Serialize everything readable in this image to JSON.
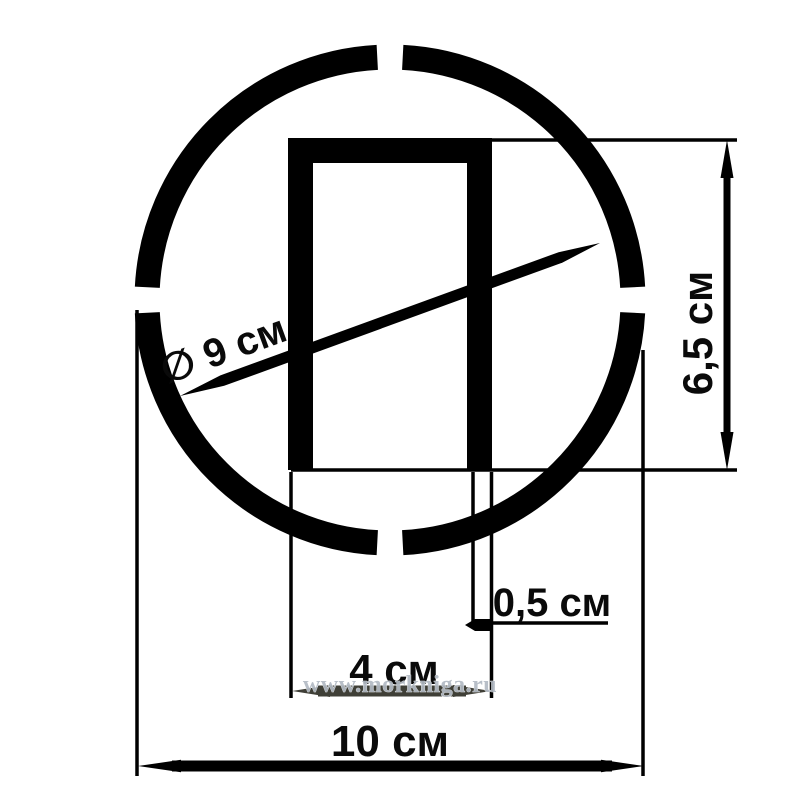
{
  "diagram": {
    "type": "technical-dimension-drawing",
    "subject": "circular-stencil-with-slot",
    "background_color": "#ffffff",
    "ink_color": "#000000",
    "overlapped_line_color": "#3f3f37",
    "labels": {
      "diameter": "∅ 9 см",
      "slot_height": "6,5 см",
      "stroke_thickness": "0,5 см",
      "slot_width": "4 см",
      "overall_width": "10 см"
    },
    "measurements": [
      {
        "name": "inner-circle-diameter",
        "value": 9,
        "unit": "см",
        "text": "∅ 9 см"
      },
      {
        "name": "slot-height",
        "value": 6.5,
        "unit": "см",
        "text": "6,5 см"
      },
      {
        "name": "stroke-thickness",
        "value": 0.5,
        "unit": "см",
        "text": "0,5 см"
      },
      {
        "name": "slot-width",
        "value": 4,
        "unit": "см",
        "text": "4 см"
      },
      {
        "name": "overall-width",
        "value": 10,
        "unit": "см",
        "text": "10 см"
      }
    ],
    "watermark": {
      "text": "www.morkniga.ru",
      "color": "#b2bac4"
    }
  }
}
